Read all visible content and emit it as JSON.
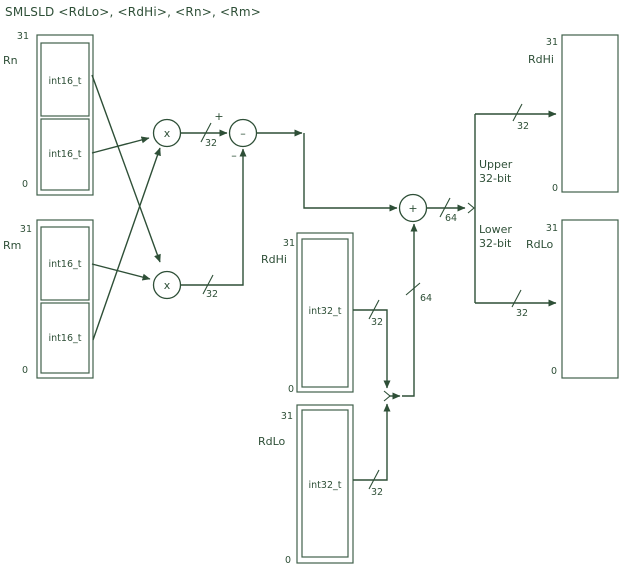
{
  "title": "SMLSLD  <RdLo>,  <RdHi>, <Rn>, <Rm>",
  "colors": {
    "ink": "#2e4f37",
    "box_outline": "#41604b",
    "background": "#ffffff"
  },
  "operators": {
    "multiply": "x",
    "subtract": "–",
    "add": "+"
  },
  "signs": {
    "plus": "+",
    "minus": "–"
  },
  "bus": {
    "b32": "32",
    "b64": "64"
  },
  "annotations": {
    "upper_line1": "Upper",
    "upper_line2": "32-bit",
    "lower_line1": "Lower",
    "lower_line2": "32-bit"
  },
  "registers": {
    "rn": {
      "name": "Rn",
      "msb": "31",
      "lsb": "0",
      "field_high": "int16_t",
      "field_low": "int16_t"
    },
    "rm": {
      "name": "Rm",
      "msb": "31",
      "lsb": "0",
      "field_high": "int16_t",
      "field_low": "int16_t"
    },
    "rdhi_src": {
      "name": "RdHi",
      "msb": "31",
      "lsb": "0",
      "field": "int32_t"
    },
    "rdlo_src": {
      "name": "RdLo",
      "msb": "31",
      "lsb": "0",
      "field": "int32_t"
    },
    "rdhi_dst": {
      "name": "RdHi",
      "msb": "31",
      "lsb": "0"
    },
    "rdlo_dst": {
      "name": "RdLo",
      "msb": "31",
      "lsb": "0"
    }
  }
}
